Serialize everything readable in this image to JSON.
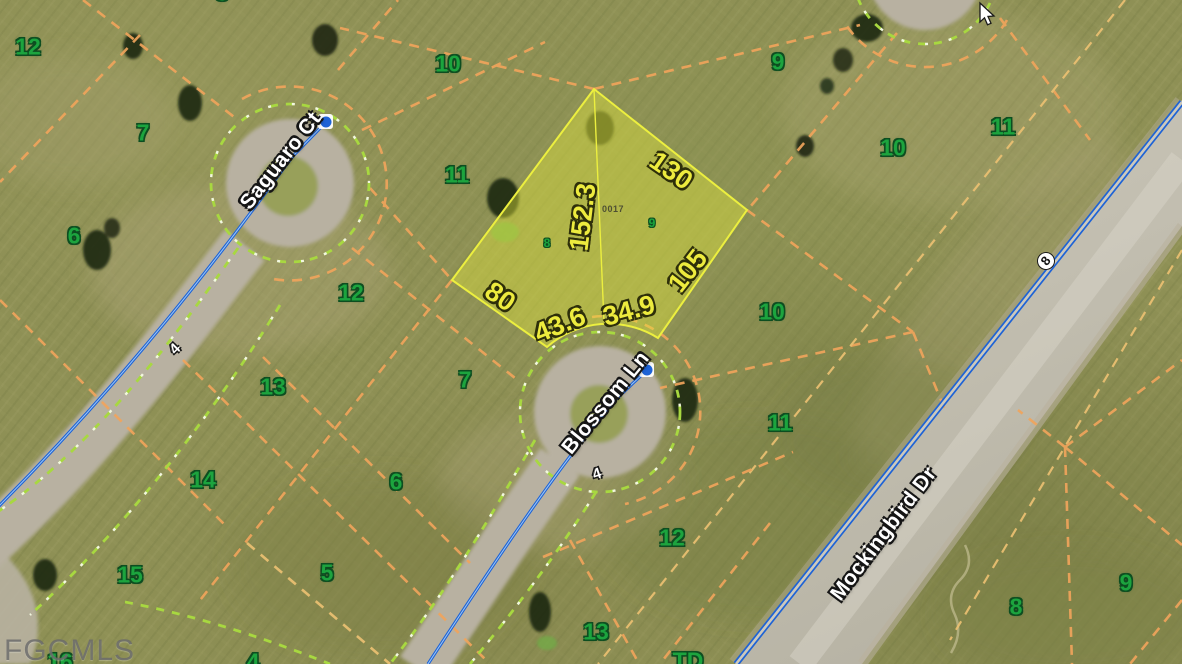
{
  "map": {
    "watermark": "FGCMLS",
    "roads": {
      "saguaro": {
        "name": "Saguaro Ct",
        "marker": "4"
      },
      "blossom": {
        "name": "Blossom Ln",
        "marker": "4"
      },
      "mockingbird": {
        "name": "Mockingbird Dr",
        "marker": "8"
      }
    },
    "subject_lot": {
      "parcel_id": "0017",
      "sub_parcels": {
        "left": "8",
        "right": "9"
      },
      "dimensions": {
        "top_right": "130",
        "middle": "152.3",
        "bottom_right": "105",
        "left": "80",
        "arc_left": "43.6",
        "arc_right": "34.9"
      }
    },
    "parcel_numbers": [
      "12",
      "8",
      "7",
      "6",
      "10",
      "11",
      "12",
      "9",
      "10",
      "11",
      "10",
      "11",
      "13",
      "7",
      "14",
      "6",
      "15",
      "5",
      "12",
      "13",
      "8",
      "9",
      "16",
      "4",
      "TD"
    ],
    "colors": {
      "parcel_line": "#f0a45c",
      "road_edge_dash": "#a8d840",
      "road_centerline": "#1e63d6",
      "lot_outline": "#ecef3f",
      "parcel_number_green": "#1ca43e",
      "dimension_yellow": "#edeb3e",
      "pavement": "#c9c5b8",
      "gravel": "#b8b1a1"
    }
  }
}
